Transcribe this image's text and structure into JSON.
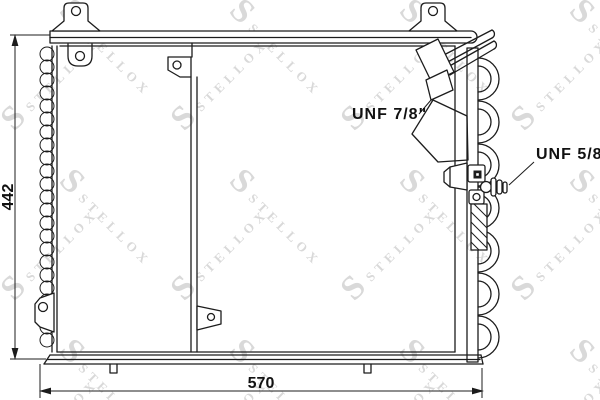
{
  "diagram": {
    "dimension_height": "442",
    "dimension_width": "570",
    "fitting_top": "UNF 7/8\"",
    "fitting_side": "UNF 5/8\"",
    "watermark_brand": "STELLOX",
    "watermark_logo_letter": "S",
    "colors": {
      "line": "#1c1c1c",
      "watermark": "#d9d9d9",
      "background": "#ffffff"
    }
  }
}
